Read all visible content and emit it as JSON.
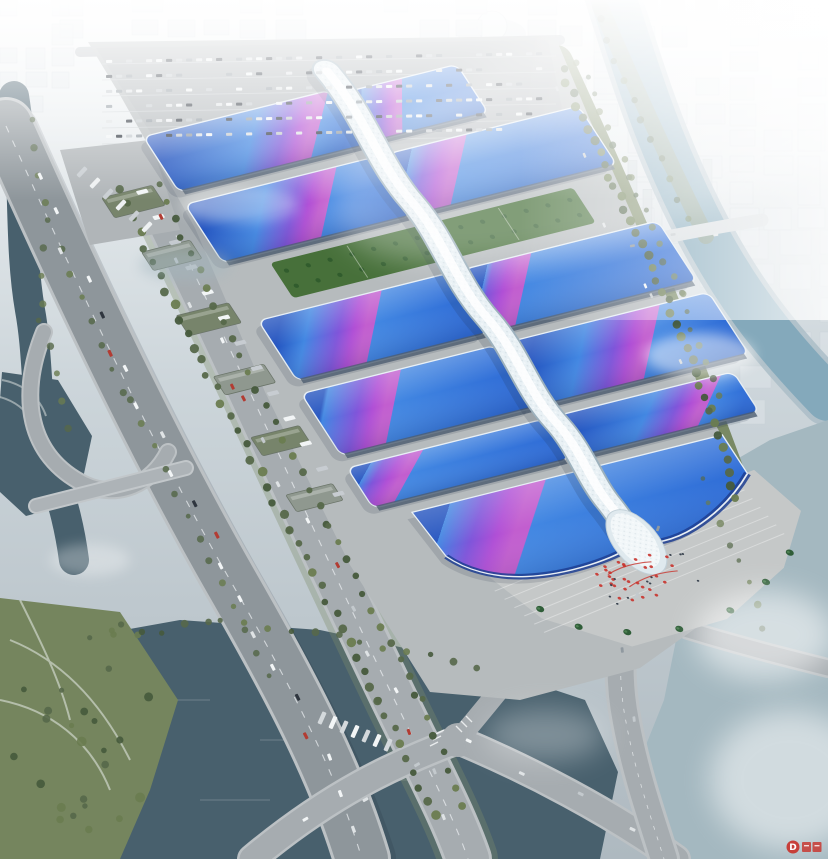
{
  "meta": {
    "title": "Aerial rendering — riverside exhibition and convention center",
    "type": "architectural-aerial-render"
  },
  "scene": {
    "description": "Bird's-eye architectural rendering of a large riverside exhibition complex: paired wave-form hall roofs in blue with violet-magenta ribbon gradients flank a white serpentine central concourse that ends at a grand south entrance hall and ceremonial plaza with red decorations and palm trees; surrounded by a parking apron, tree-lined boulevards, an elevated expressway, canals, a lake and a hazy white city skyline.",
    "areas": [
      "exhibition halls",
      "central serpentine concourse",
      "grand entrance hall",
      "entrance plaza",
      "north parking apron",
      "elevated expressway",
      "riverside boulevard",
      "canal",
      "lake",
      "river",
      "city in haze"
    ],
    "halls": [
      {
        "name": "hall-1-west",
        "x": -200,
        "y": 4,
        "w": 192,
        "h": 66,
        "c": 0.78
      },
      {
        "name": "hall-1-east",
        "x": 8,
        "y": 10,
        "w": 112,
        "h": 58,
        "c": 0.3
      },
      {
        "name": "hall-2-west",
        "x": -202,
        "y": 84,
        "w": 194,
        "h": 70,
        "c": 0.6
      },
      {
        "name": "hall-2-east",
        "x": 8,
        "y": 84,
        "w": 196,
        "h": 70,
        "c": 0.22
      },
      {
        "name": "hall-3-west",
        "x": -204,
        "y": 222,
        "w": 196,
        "h": 72,
        "c": 0.45
      },
      {
        "name": "hall-3-east",
        "x": 8,
        "y": 222,
        "w": 200,
        "h": 72,
        "c": 0.16
      },
      {
        "name": "hall-4-west",
        "x": -208,
        "y": 308,
        "w": 200,
        "h": 74,
        "c": 0.32
      },
      {
        "name": "hall-4-east",
        "x": 8,
        "y": 308,
        "w": 204,
        "h": 74,
        "c": 0.55
      },
      {
        "name": "hall-5-west",
        "x": -210,
        "y": 396,
        "w": 202,
        "h": 48,
        "c": 0.2
      },
      {
        "name": "hall-5-east",
        "x": 8,
        "y": 396,
        "w": 180,
        "h": 48,
        "c": 0.72
      },
      {
        "name": "grand-entrance-hall",
        "shape": "grand",
        "c": 0.24
      }
    ],
    "gardens": [
      {
        "x": -160,
        "y": 166,
        "w": 312,
        "h": 42
      }
    ],
    "warehouses": [
      {
        "x": -272,
        "y": 56,
        "w": 52,
        "h": 24
      },
      {
        "x": -268,
        "y": 122,
        "w": 50,
        "h": 22
      },
      {
        "x": -274,
        "y": 196,
        "w": 54,
        "h": 24
      },
      {
        "x": -276,
        "y": 268,
        "w": 52,
        "h": 22
      },
      {
        "x": -278,
        "y": 340,
        "w": 50,
        "h": 22
      },
      {
        "x": -280,
        "y": 408,
        "w": 48,
        "h": 20
      }
    ]
  },
  "palette": {
    "sky_top": "#f6f8f9",
    "sky_mid": "#ccd5da",
    "sky_low": "#aeb9c0",
    "haze": "#ffffff",
    "water_dark": "#48606d",
    "water_river": "#84a9bb",
    "water_mist": "#a4b8c0",
    "road_major": "#8e969b",
    "road_minor": "#a6acb0",
    "road_edge": "#bcc1c4",
    "platform": "#b6bbbd",
    "parking": "#b0b5b8",
    "plaza": "#c5c8c8",
    "roof_blue": "#2e6bd6",
    "roof_blue_deep": "#2353bf",
    "roof_blue_light": "#4287e2",
    "ribbon_violet": "#7f55da",
    "ribbon_magenta": "#c25ecf",
    "spine_white": "#e9f1f5",
    "garden_green": "#47703a",
    "tree_green": "#56684a",
    "tree_dark": "#465a3c",
    "park_green": "#75855e",
    "facade": "#4e5e70",
    "city_block": "#e3e8ec",
    "accent_red": "#c8332c"
  },
  "watermark": {
    "logo_letter": "D"
  }
}
